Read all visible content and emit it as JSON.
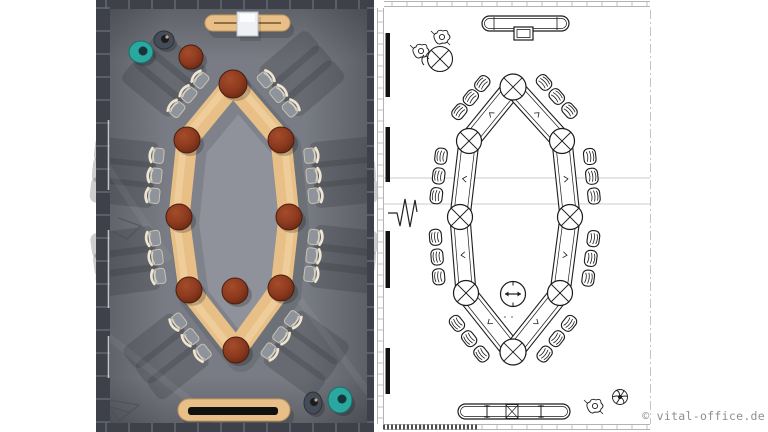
{
  "meta": {
    "width": 768,
    "height": 432,
    "description": "Conference room furniture layout: photorealistic top view (left) and CAD plan drawing (right)"
  },
  "watermark": {
    "text": "© vital-office.de",
    "color": "#8f8f8f"
  },
  "render_panel": {
    "x": 96,
    "w": 278,
    "colors": {
      "floor": "#797c84",
      "floor_inner": "#8f929a",
      "wall": "#3e414a",
      "wall_joint": "#666a72",
      "wood": "#e7bf87",
      "wood_hi": "#f4d9ab",
      "wood_edge": "#c49a60",
      "red": "#8c3a1f",
      "red_hi": "#a54c2b",
      "red_dark": "#4a1d0e",
      "chair_seat": "#8f949c",
      "chair_back": "#eee6d2",
      "chair_rim": "#c9c2ae",
      "shadow": "#2e3138",
      "teal": "#2aa79e",
      "teal_dark": "#186f68",
      "person_dark": "#454b57",
      "slot": "#111111",
      "media_box": "#eef0f3",
      "media_edge": "#b9bcc2",
      "sill": "#c2c5c9"
    },
    "nodes": [
      [
        233,
        84,
        14
      ],
      [
        187,
        140,
        13
      ],
      [
        179,
        217,
        13
      ],
      [
        189,
        290,
        13
      ],
      [
        236,
        350,
        13
      ],
      [
        281,
        288,
        13
      ],
      [
        289,
        217,
        13
      ],
      [
        281,
        140,
        13
      ]
    ],
    "segments": [
      [
        0,
        1
      ],
      [
        1,
        2
      ],
      [
        2,
        3
      ],
      [
        3,
        4
      ],
      [
        4,
        5
      ],
      [
        5,
        6
      ],
      [
        6,
        7
      ],
      [
        7,
        0
      ]
    ],
    "segment_width": 21,
    "chair_t": [
      0.24,
      0.5,
      0.76
    ],
    "chair_offset": 27,
    "center_table": [
      235,
      291,
      13
    ],
    "side_table": [
      191,
      57,
      12
    ],
    "sideboard_top": {
      "x": 205,
      "y": 15,
      "w": 85,
      "h": 16,
      "box": [
        237,
        12,
        21,
        24
      ]
    },
    "sideboard_bottom": {
      "x": 178,
      "y": 399,
      "w": 112,
      "h": 22,
      "slot": [
        188,
        407,
        90,
        8
      ]
    },
    "people": [
      {
        "x": 141,
        "y": 52,
        "rx": 12,
        "ry": 11,
        "type": "teal"
      },
      {
        "x": 164,
        "y": 40,
        "rx": 10,
        "ry": 9,
        "type": "dark"
      },
      {
        "x": 313,
        "y": 403,
        "rx": 9,
        "ry": 11,
        "type": "dark"
      },
      {
        "x": 340,
        "y": 400,
        "rx": 12,
        "ry": 13,
        "type": "teal"
      }
    ],
    "sill_segments": [
      [
        120,
        190
      ],
      [
        230,
        308
      ],
      [
        336,
        378
      ]
    ]
  },
  "cad_panel": {
    "colors": {
      "line": "#1c1c1c",
      "faint": "#b3b3b3",
      "blue": "#c3ccd3",
      "dashdot": "#c9c2c2",
      "bar": "#101010",
      "dense": "#3a3a3a"
    },
    "nodes": [
      [
        513,
        87,
        13
      ],
      [
        469,
        141,
        12.5
      ],
      [
        460,
        217,
        12.5
      ],
      [
        466,
        293,
        12.5
      ],
      [
        513,
        352,
        13
      ],
      [
        560,
        293,
        12.5
      ],
      [
        570,
        217,
        12.5
      ],
      [
        562,
        141,
        12.5
      ]
    ],
    "segments": [
      [
        0,
        1
      ],
      [
        1,
        2
      ],
      [
        2,
        3
      ],
      [
        3,
        4
      ],
      [
        4,
        5
      ],
      [
        5,
        6
      ],
      [
        6,
        7
      ],
      [
        7,
        0
      ]
    ],
    "segment_width": 20,
    "chair_t": [
      0.24,
      0.5,
      0.76
    ],
    "chair_offset": 26,
    "center_table": [
      513,
      294,
      12.5
    ],
    "side_table": [
      440,
      59,
      12.5
    ],
    "sideboard_top": {
      "x": 482,
      "y": 16,
      "w": 87,
      "h": 15,
      "box": [
        514,
        27,
        19,
        13
      ]
    },
    "sideboard_bottom": {
      "x": 458,
      "y": 404,
      "w": 112,
      "h": 15
    },
    "wall_bars": [
      [
        33,
        97
      ],
      [
        127,
        182
      ],
      [
        231,
        288
      ],
      [
        348,
        394
      ]
    ],
    "grid_lines_y": [
      178,
      204
    ],
    "sheet": {
      "col_x1": 377.5,
      "col_x2": 383.5,
      "col_top": 8,
      "col_bottom": 424,
      "strip_x1": 384,
      "strip_x2": 650,
      "top_y1": 1.5,
      "top_y2": 6.5,
      "bottom_y1": 424.5,
      "bottom_y2": 429.5,
      "dense_end_x": 478,
      "dashdot_x": 650.5
    },
    "people": [
      [
        420,
        52,
        "s"
      ],
      [
        441,
        38,
        "s"
      ],
      [
        594,
        407,
        "s"
      ],
      [
        620,
        397,
        "w"
      ]
    ],
    "dots": [
      [
        505,
        317
      ],
      [
        512,
        317
      ]
    ]
  }
}
